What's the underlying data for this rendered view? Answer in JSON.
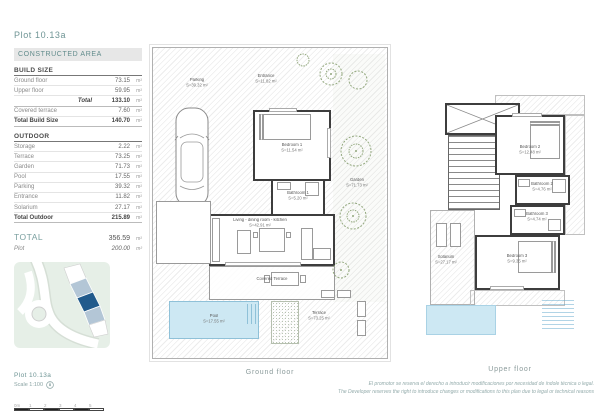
{
  "panel": {
    "title": "Plot 10.13a",
    "constructed_area_header": "CONSTRUCTED AREA",
    "build_size": {
      "title": "BUILD SIZE",
      "rows": [
        {
          "label": "Ground floor",
          "value": "73.15",
          "unit": "m²"
        },
        {
          "label": "Upper floor",
          "value": "59.95",
          "unit": "m²"
        },
        {
          "label": "Total",
          "value": "133.10",
          "unit": "m²"
        },
        {
          "label": "Covered terrace",
          "value": "7.60",
          "unit": "m²"
        },
        {
          "label": "Total Build Size",
          "value": "140.70",
          "unit": "m²"
        }
      ]
    },
    "outdoor": {
      "title": "OUTDOOR",
      "rows": [
        {
          "label": "Storage",
          "value": "2.22",
          "unit": "m²"
        },
        {
          "label": "Terrace",
          "value": "73.25",
          "unit": "m²"
        },
        {
          "label": "Garden",
          "value": "71.73",
          "unit": "m²"
        },
        {
          "label": "Pool",
          "value": "17.55",
          "unit": "m²"
        },
        {
          "label": "Parking",
          "value": "39.32",
          "unit": "m²"
        },
        {
          "label": "Entrance",
          "value": "11.82",
          "unit": "m²"
        },
        {
          "label": "Solarium",
          "value": "27.17",
          "unit": "m²"
        },
        {
          "label": "Total Outdoor",
          "value": "215.89",
          "unit": "m²"
        }
      ]
    },
    "total": {
      "label": "TOTAL",
      "value": "356.59",
      "unit": "m²"
    },
    "plot": {
      "label": "Plot",
      "value": "200.00",
      "unit": "m²"
    },
    "map_caption": {
      "title": "Plot 10.13a",
      "scale": "Scale 1:100"
    },
    "scale_bar_ticks": [
      "0m",
      "1",
      "2",
      "3",
      "4",
      "5"
    ]
  },
  "plans": {
    "ground": {
      "caption": "Ground floor",
      "rooms": {
        "parking": {
          "name": "Parking",
          "area": "S=39.32 m²"
        },
        "entrance": {
          "name": "Entrance",
          "area": "S=11.82 m²"
        },
        "bedroom1": {
          "name": "Bedroom 1",
          "area": "S=11.54 m²"
        },
        "bathroom1": {
          "name": "Bathroom 1",
          "area": "S=5.20 m²"
        },
        "garden": {
          "name": "Garden",
          "area": "S=71.73 m²"
        },
        "storage": {
          "name": "Storage",
          "area": "S=2.22 m²"
        },
        "living": {
          "name": "Living - dining room - kitchen",
          "area": "S=42.91 m²"
        },
        "covered_terrace": {
          "name": "Covered Terrace"
        },
        "pool": {
          "name": "Pool",
          "area": "S=17.55 m²"
        },
        "terrace": {
          "name": "Terrace",
          "area": "S=73.25 m²"
        }
      }
    },
    "upper": {
      "caption": "Upper floor",
      "rooms": {
        "bedroom2": {
          "name": "Bedroom 2",
          "area": "S=12.48 m²"
        },
        "bathroom2": {
          "name": "Bathroom 2",
          "area": "S=4.76 m²"
        },
        "bathroom3": {
          "name": "Bathroom 3",
          "area": "S=4.74 m²"
        },
        "bedroom3": {
          "name": "Bedroom 3",
          "area": "S=9.35 m²"
        },
        "solarium": {
          "name": "Solarium",
          "area": "S=27.17 m²"
        }
      }
    }
  },
  "footer": {
    "line1": "El promotor se reserva el derecho a introducir modificaciones por necesidad de índole técnica o legal.",
    "line2": "The Developer reserves the right to introduce changes or modifications to this plan due to legal or technical reasons"
  },
  "colors": {
    "accent_teal": "#6f9595",
    "highlight_plot_blue": "#215a8c",
    "light_plot_blue": "#b3c6d6",
    "pool_blue": "#cde8f3",
    "site_map_green": "#e6efe7"
  }
}
